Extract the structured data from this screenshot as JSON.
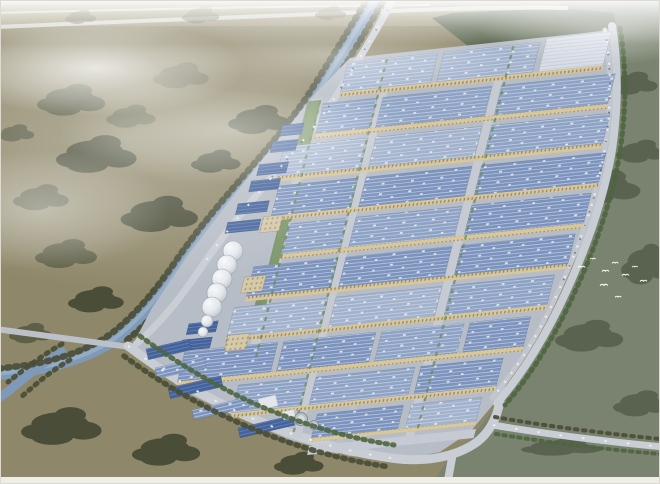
{
  "scene": {
    "type": "aerial-architectural-rendering",
    "subject": "Bird's-eye architectural rendering of a large industrial park: diagonal rows of blue-roofed factory warehouses with tan facade strips, a tree-lined canal winding along the west side, perimeter roads with parked cars, a row of white storage tanks, beige office blocks, surrounded by hazy olive farmland, dark green fields and a flock of white birds",
    "counts": {
      "large_factory_rows": 10,
      "storage_tanks": 5,
      "small_tanks": 2,
      "clarifier_pools": 2,
      "birds": 9
    },
    "palette": {
      "haze": "#eef0ee",
      "farmland": "#8e8769",
      "farmland_light": "#a39a7e",
      "field_right": "#7a8370",
      "field_right_dark": "#5a6350",
      "field_top_dark": "#55624b",
      "tree_dark": "#4a4d37",
      "tree_olive": "#5d5f46",
      "tree_green": "#4e653f",
      "tree_park": "#6b8a52",
      "water": "#7e9ab8",
      "water_light": "#a8bcd0",
      "road": "#c9cdd4",
      "road_minor": "#bcc1c9",
      "park_ground": "#b7bdc6",
      "roof_light": "#a2b2cc",
      "roof_med": "#8da2c4",
      "roof_blue": "#7b93bd",
      "roof_dark": "#44639c",
      "roof_white": "#d7dde6",
      "ridge_line": "#d8e0ec",
      "facade_tan": "#d9c79c",
      "facade_dark": "#8a7a55",
      "office_beige": "#d6c9a8",
      "tank_white": "#f2f4f5",
      "car_white": "#eef0f2",
      "bird_white": "#ffffff",
      "frame": "#efeee6"
    }
  }
}
